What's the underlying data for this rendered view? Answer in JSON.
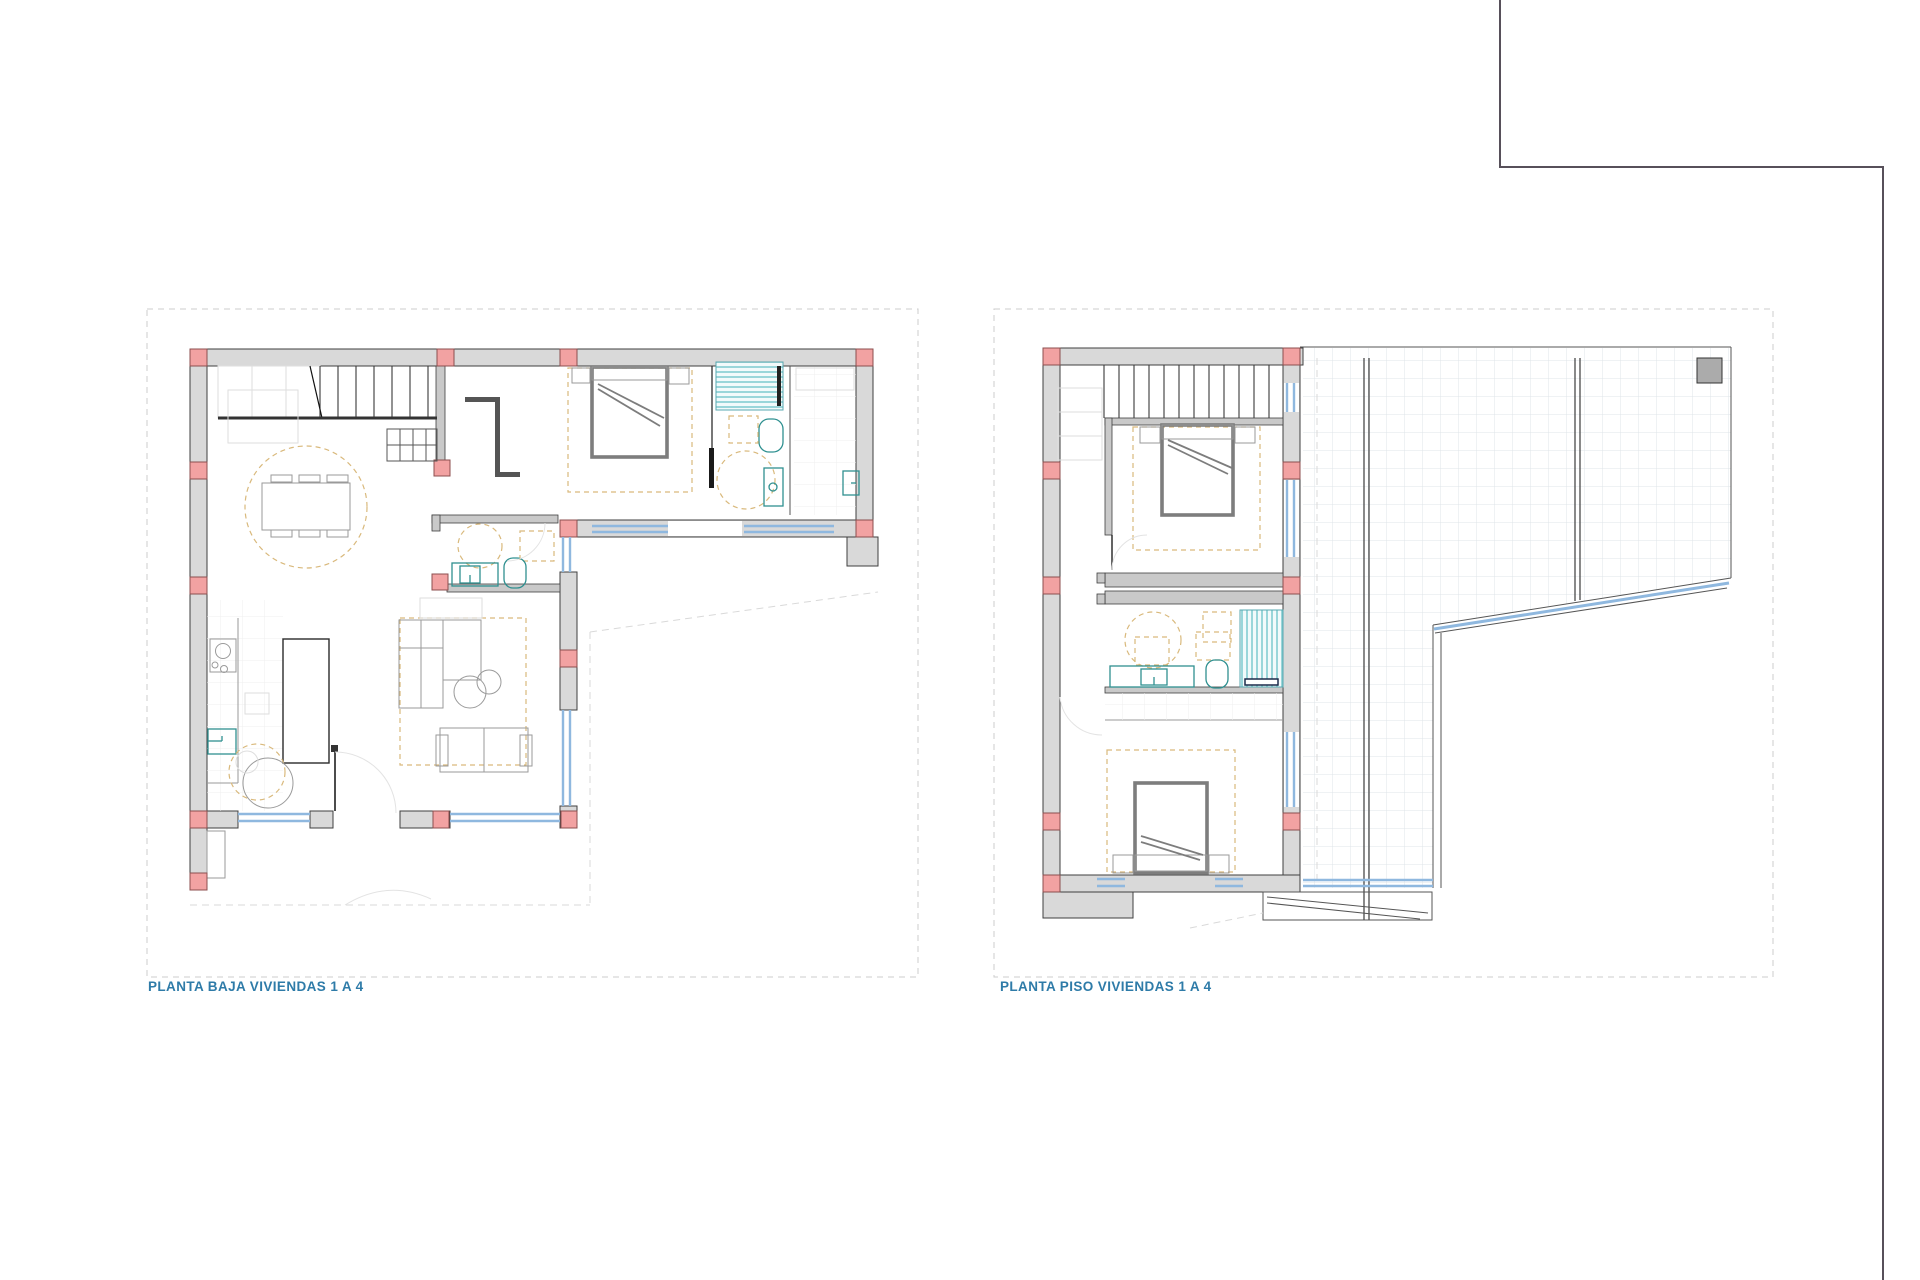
{
  "page": {
    "width": 1920,
    "height": 1280,
    "background": "#ffffff"
  },
  "sheet_frame": {
    "description": "drawing sheet border, top-right step",
    "color": "#57505a"
  },
  "panels": [
    {
      "id": "planta-baja",
      "label": "PLANTA BAJA VIVIENDAS 1 A 4",
      "features": [
        "staircase",
        "dining-table-six-chairs",
        "kitchen-hob",
        "kitchen-sink",
        "kitchen-island",
        "round-breakfast-table",
        "l-shaped-sofa",
        "two-seat-sofa",
        "double-bed",
        "en-suite-shower",
        "toilet",
        "washbasin",
        "guest-bathroom",
        "entry-door-arc",
        "window-strips",
        "structural-columns",
        "utility-room-tiles"
      ]
    },
    {
      "id": "planta-piso",
      "label": "PLANTA PISO VIVIENDAS 1 A 4",
      "features": [
        "staircase",
        "double-bed-north",
        "double-bed-south",
        "bathroom-shower",
        "toilet",
        "washbasin",
        "corridor-tiles",
        "roof-terrace-tiled",
        "terrace-skylight",
        "balcony-ramp",
        "window-strips",
        "structural-columns"
      ]
    }
  ],
  "colors": {
    "wall-fill": "#d9d9d9",
    "line-dark": "#3f3f3f",
    "col-fill": "#f2a2a2",
    "col-stroke": "#8c4f4f",
    "window-blue": "#8fb8df",
    "furn": "#9a9a9a",
    "furn-faint": "#dedede",
    "bed": "#7d7d7d",
    "teal": "#2f9090",
    "dash-y": "#d9b97c",
    "stair": "#3a3a3a",
    "tile": "#e0e5ea",
    "site": "#d9d9d9",
    "panel": "#cccccc",
    "sheet": "#57505a",
    "label": "#2e7ba8",
    "stripe": "#7ccad0"
  }
}
